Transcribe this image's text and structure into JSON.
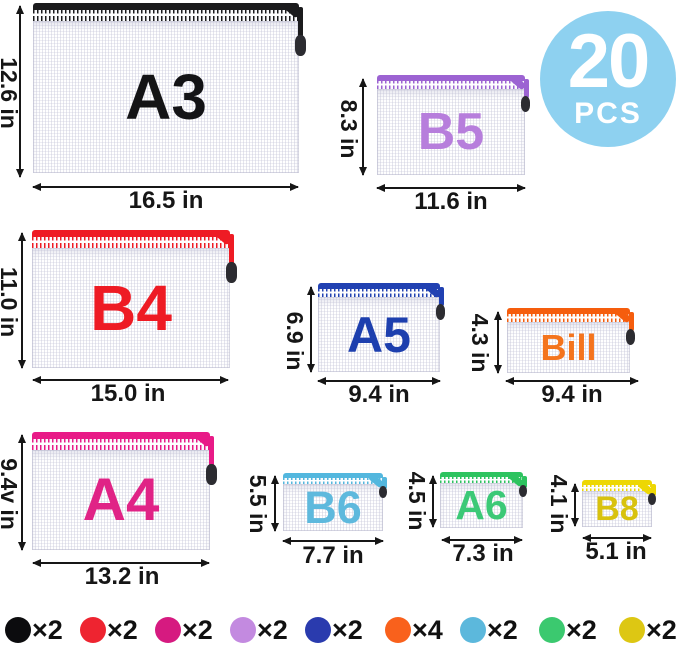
{
  "badge": {
    "count": "20",
    "unit": "PCS",
    "bg": "#8ed1f0",
    "text_color": "#ffffff"
  },
  "bags": [
    {
      "label": "A3",
      "height_label": "12.6 in",
      "width_label": "16.5 in",
      "zipper_color": "#1b1b1d",
      "label_color": "#141416"
    },
    {
      "label": "B5",
      "height_label": "8.3 in",
      "width_label": "11.6 in",
      "zipper_color": "#9c63d2",
      "label_color": "#b77edc"
    },
    {
      "label": "B4",
      "height_label": "11.0 in",
      "width_label": "15.0 in",
      "zipper_color": "#ee1b24",
      "label_color": "#ee1b24"
    },
    {
      "label": "A5",
      "height_label": "6.9 in",
      "width_label": "9.4 in",
      "zipper_color": "#2141b2",
      "label_color": "#1d3fae"
    },
    {
      "label": "Bill",
      "height_label": "4.3 in",
      "width_label": "9.4 in",
      "zipper_color": "#f55d0d",
      "label_color": "#f4741d"
    },
    {
      "label": "A4",
      "height_label": "9.4v in",
      "width_label": "13.2 in",
      "zipper_color": "#e81a87",
      "label_color": "#e02386"
    },
    {
      "label": "B6",
      "height_label": "5.5 in",
      "width_label": "7.7 in",
      "zipper_color": "#53b7de",
      "label_color": "#5eb9dd"
    },
    {
      "label": "A6",
      "height_label": "4.5 in",
      "width_label": "7.3 in",
      "zipper_color": "#2dc35f",
      "label_color": "#3cc977"
    },
    {
      "label": "B8",
      "height_label": "4.1 in",
      "width_label": "5.1 in",
      "zipper_color": "#edd703",
      "label_color": "#d8c20e"
    }
  ],
  "legend": [
    {
      "name": "black",
      "color": "#0c0c0e",
      "label": "×2"
    },
    {
      "name": "red",
      "color": "#ee2430",
      "label": "×2"
    },
    {
      "name": "magenta",
      "color": "#d61a80",
      "label": "×2"
    },
    {
      "name": "violet",
      "color": "#c38ae0",
      "label": "×2"
    },
    {
      "name": "blue",
      "color": "#2a3bae",
      "label": "×2"
    },
    {
      "name": "orange",
      "color": "#f9611c",
      "label": "×4"
    },
    {
      "name": "sky-blue",
      "color": "#5cb8dc",
      "label": "×2"
    },
    {
      "name": "green",
      "color": "#3bc96f",
      "label": "×2"
    },
    {
      "name": "yellow",
      "color": "#ddc713",
      "label": "×2"
    }
  ]
}
